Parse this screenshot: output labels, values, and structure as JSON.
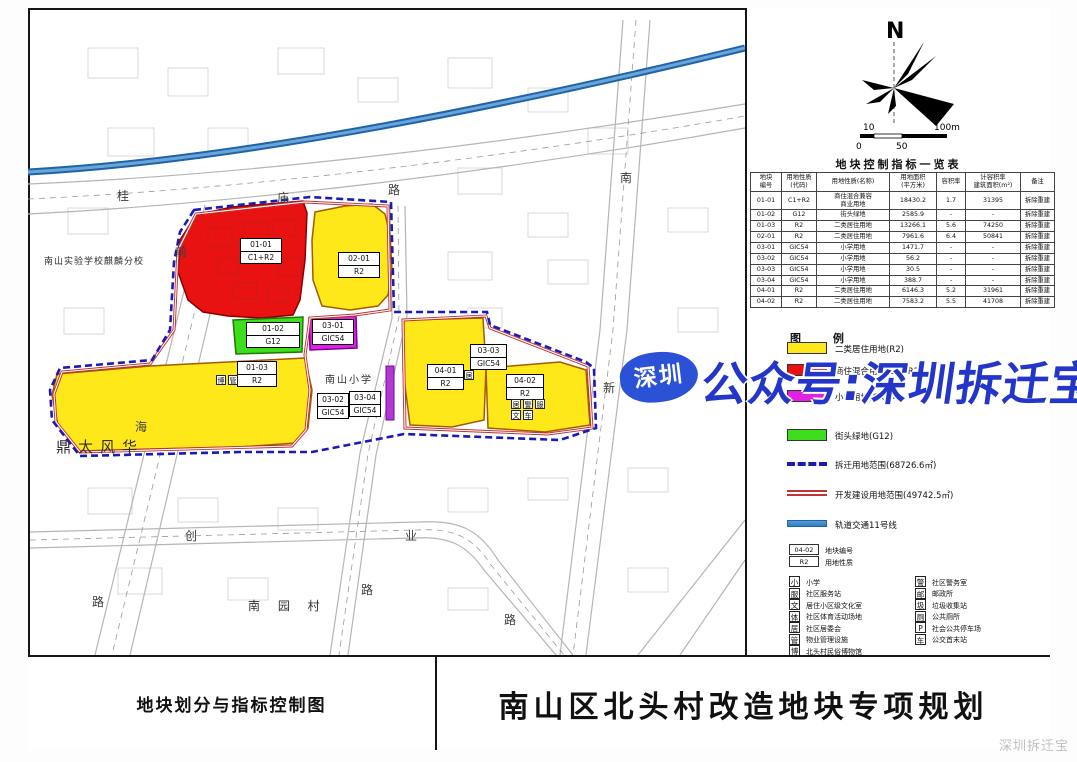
{
  "title_block": {
    "left": "地块划分与指标控制图",
    "right": "南山区北头村改造地块专项规划"
  },
  "compass": {
    "north_label": "N"
  },
  "scale_bar": {
    "tick_10": "10",
    "tick_100m": "100m",
    "tick_0": "0",
    "tick_50": "50"
  },
  "table": {
    "title": "地块控制指标一览表",
    "headers": [
      "地块\n编号",
      "用地性质\n(代码)",
      "用地性质(名称)",
      "用地面积\n(平方米)",
      "容积率",
      "计容积率\n建筑面积(m²)",
      "备注"
    ],
    "col_widths": [
      30,
      34,
      72,
      46,
      28,
      54,
      33
    ],
    "rows": [
      [
        "01-01",
        "C1+R2",
        "商住混合兼容\n商业用地",
        "18430.2",
        "1.7",
        "31395",
        "拆除重建"
      ],
      [
        "01-02",
        "G12",
        "街头绿地",
        "2585.9",
        "-",
        "-",
        "拆除重建"
      ],
      [
        "01-03",
        "R2",
        "二类居住用地",
        "13266.1",
        "5.6",
        "74250",
        "拆除重建"
      ],
      [
        "02-01",
        "R2",
        "二类居住用地",
        "7961.6",
        "6.4",
        "50841",
        "拆除重建"
      ],
      [
        "03-01",
        "GIC54",
        "小学用地",
        "1471.7",
        "-",
        "-",
        "拆除重建"
      ],
      [
        "03-02",
        "GIC54",
        "小学用地",
        "56.2",
        "-",
        "-",
        "拆除重建"
      ],
      [
        "03-03",
        "GIC54",
        "小学用地",
        "30.5",
        "-",
        "-",
        "拆除重建"
      ],
      [
        "03-04",
        "GIC54",
        "小学用地",
        "388.7",
        "-",
        "-",
        "拆除重建"
      ],
      [
        "04-01",
        "R2",
        "二类居住用地",
        "6146.3",
        "5.2",
        "31961",
        "拆除重建"
      ],
      [
        "04-02",
        "R2",
        "二类居住用地",
        "7583.2",
        "5.5",
        "41708",
        "拆除重建"
      ]
    ]
  },
  "legend": {
    "title": "图  例",
    "items": [
      {
        "type": "fill",
        "color": "#ffe81a",
        "label": "二类居住用地(R2)",
        "top": 334
      },
      {
        "type": "fill",
        "color": "#e81212",
        "label": "商住混合用地(C1+R2)",
        "top": 356
      },
      {
        "type": "fill",
        "color": "#e41fe4",
        "label": "小学用地(GIC54)",
        "top": 382
      },
      {
        "type": "fill",
        "color": "#3ede1e",
        "label": "街头绿地(G12)",
        "top": 421
      },
      {
        "type": "dash",
        "color": "#1a1ab8",
        "label": "拆迁用地范围(68726.6㎡)",
        "top": 450
      },
      {
        "type": "redline",
        "color": "#c03434",
        "label": "开发建设用地范围(49742.5㎡)",
        "top": 480
      },
      {
        "type": "metro",
        "color": "#2e7fc0",
        "label": "轨道交通11号线",
        "top": 510
      }
    ],
    "sample": {
      "code": "04-02",
      "code_label": "地块编号",
      "use": "R2",
      "use_label": "用地性质"
    }
  },
  "facility_legend": {
    "left": [
      {
        "glyph": "小",
        "icon": "primary-school-icon",
        "label": "小学"
      },
      {
        "glyph": "服",
        "icon": "community-service-station-icon",
        "label": "社区服务站"
      },
      {
        "glyph": "文",
        "icon": "culture-room-icon",
        "label": "居住小区级文化室"
      },
      {
        "glyph": "体",
        "icon": "sports-ground-icon",
        "label": "社区体育活动场地"
      },
      {
        "glyph": "居",
        "icon": "residents-committee-icon",
        "label": "社区居委会"
      },
      {
        "glyph": "管",
        "icon": "property-management-icon",
        "label": "物业管理设施"
      },
      {
        "glyph": "博",
        "icon": "folk-museum-icon",
        "label": "北头村民俗博物馆"
      }
    ],
    "right": [
      {
        "glyph": "警",
        "icon": "community-police-icon",
        "label": "社区警务室"
      },
      {
        "glyph": "邮",
        "icon": "post-office-icon",
        "label": "邮政所"
      },
      {
        "glyph": "圾",
        "icon": "garbage-collection-icon",
        "label": "垃圾收集站"
      },
      {
        "glyph": "厕",
        "icon": "public-toilet-icon",
        "label": "公共厕所"
      },
      {
        "glyph": "P",
        "icon": "public-parking-icon",
        "label": "社会公共停车场"
      },
      {
        "glyph": "车",
        "icon": "bus-terminus-icon",
        "label": "公交首末站"
      }
    ]
  },
  "map": {
    "plot_labels": [
      {
        "code": "01-01",
        "use": "C1+R2",
        "x": 212,
        "y": 230,
        "w": 42
      },
      {
        "code": "02-01",
        "use": "R2",
        "x": 310,
        "y": 244,
        "w": 42
      },
      {
        "code": "01-02",
        "use": "G12",
        "x": 218,
        "y": 314,
        "w": 54
      },
      {
        "code": "03-01",
        "use": "GIC54",
        "x": 284,
        "y": 311,
        "w": 42
      },
      {
        "code": "01-03",
        "use": "R2",
        "x": 209,
        "y": 353,
        "w": 40
      },
      {
        "code": "03-02",
        "use": "GIC54",
        "x": 289,
        "y": 385,
        "w": 32
      },
      {
        "code": "03-04",
        "use": "GIC54",
        "x": 321,
        "y": 383,
        "w": 32
      },
      {
        "code": "03-03",
        "use": "GIC54",
        "x": 442,
        "y": 336,
        "w": 37
      },
      {
        "code": "04-01",
        "use": "R2",
        "x": 399,
        "y": 356,
        "w": 37
      },
      {
        "code": "04-02",
        "use": "R2",
        "x": 478,
        "y": 366,
        "w": 38
      }
    ],
    "place_labels": [
      {
        "text": "南山实验学校麒麟分校",
        "x": 16,
        "y": 250,
        "fs": 9,
        "ls": 1
      },
      {
        "text": "鼎太风华",
        "x": 28,
        "y": 432,
        "fs": 15,
        "ls": 7
      },
      {
        "text": "南山小学",
        "x": 297,
        "y": 368,
        "fs": 10,
        "ls": 2
      },
      {
        "text": "南 园 村",
        "x": 220,
        "y": 592,
        "fs": 12,
        "ls": 7
      }
    ],
    "road_labels": [
      {
        "ch": "桂",
        "x": 89,
        "y": 182
      },
      {
        "ch": "庙",
        "x": 249,
        "y": 184
      },
      {
        "ch": "路",
        "x": 360,
        "y": 176
      },
      {
        "ch": "前",
        "x": 147,
        "y": 238
      },
      {
        "ch": "海",
        "x": 107,
        "y": 413
      },
      {
        "ch": "路",
        "x": 64,
        "y": 588
      },
      {
        "ch": "南",
        "x": 592,
        "y": 164
      },
      {
        "ch": "新",
        "x": 575,
        "y": 374
      },
      {
        "ch": "路",
        "x": 476,
        "y": 606
      },
      {
        "ch": "创",
        "x": 157,
        "y": 522
      },
      {
        "ch": "业",
        "x": 377,
        "y": 522
      },
      {
        "ch": "路",
        "x": 333,
        "y": 576
      }
    ],
    "facility_marks": [
      {
        "glyph": "博",
        "x": 188,
        "y": 367
      },
      {
        "glyph": "管",
        "x": 200,
        "y": 367
      },
      {
        "glyph": "居",
        "x": 436,
        "y": 362
      },
      {
        "glyph": "居",
        "x": 483,
        "y": 391
      },
      {
        "glyph": "警",
        "x": 495,
        "y": 391
      },
      {
        "glyph": "服",
        "x": 507,
        "y": 391
      },
      {
        "glyph": "文",
        "x": 483,
        "y": 402
      },
      {
        "glyph": "车",
        "x": 495,
        "y": 402
      }
    ]
  },
  "watermark": {
    "logo_text": "深圳",
    "main_text": "公众号:深圳拆迁宝",
    "corner_text": "深圳拆迁宝"
  }
}
